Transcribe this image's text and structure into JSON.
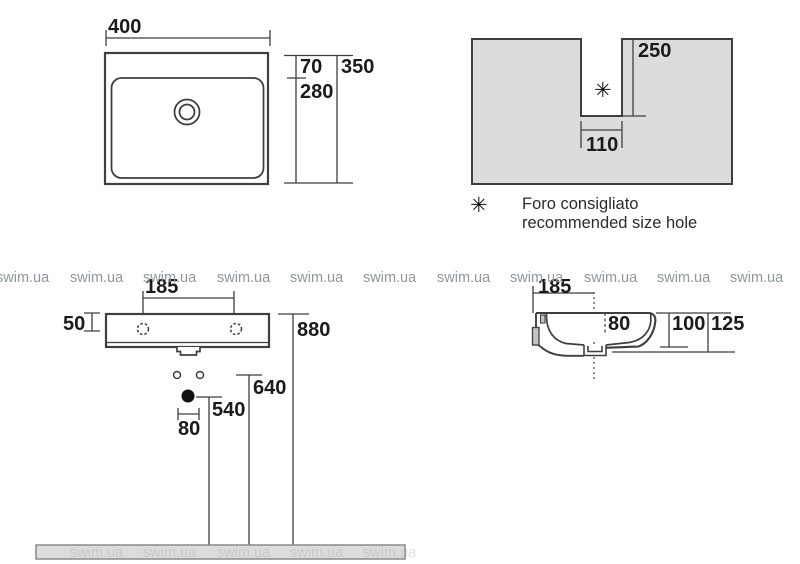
{
  "colors": {
    "line": "#3f3f3f",
    "fill_gray": "#dcdcdc",
    "text": "#1b1b1b",
    "watermark": "#8f979c"
  },
  "watermark": {
    "text": "swim.ua"
  },
  "top_view": {
    "width": "400",
    "rim": "70",
    "total": "350",
    "inner": "280"
  },
  "wall_cutout": {
    "height": "250",
    "width": "110",
    "marker": "✳"
  },
  "legend": {
    "marker": "✳",
    "line1": "Foro consigliato",
    "line2": "recommended size hole"
  },
  "front_view": {
    "tap_distance": "185",
    "rim": "50",
    "total": "880",
    "fixing": "640",
    "drain": "540",
    "drain_width": "80"
  },
  "side_view": {
    "setback": "185",
    "depth": "80",
    "front": "100",
    "total": "125"
  }
}
